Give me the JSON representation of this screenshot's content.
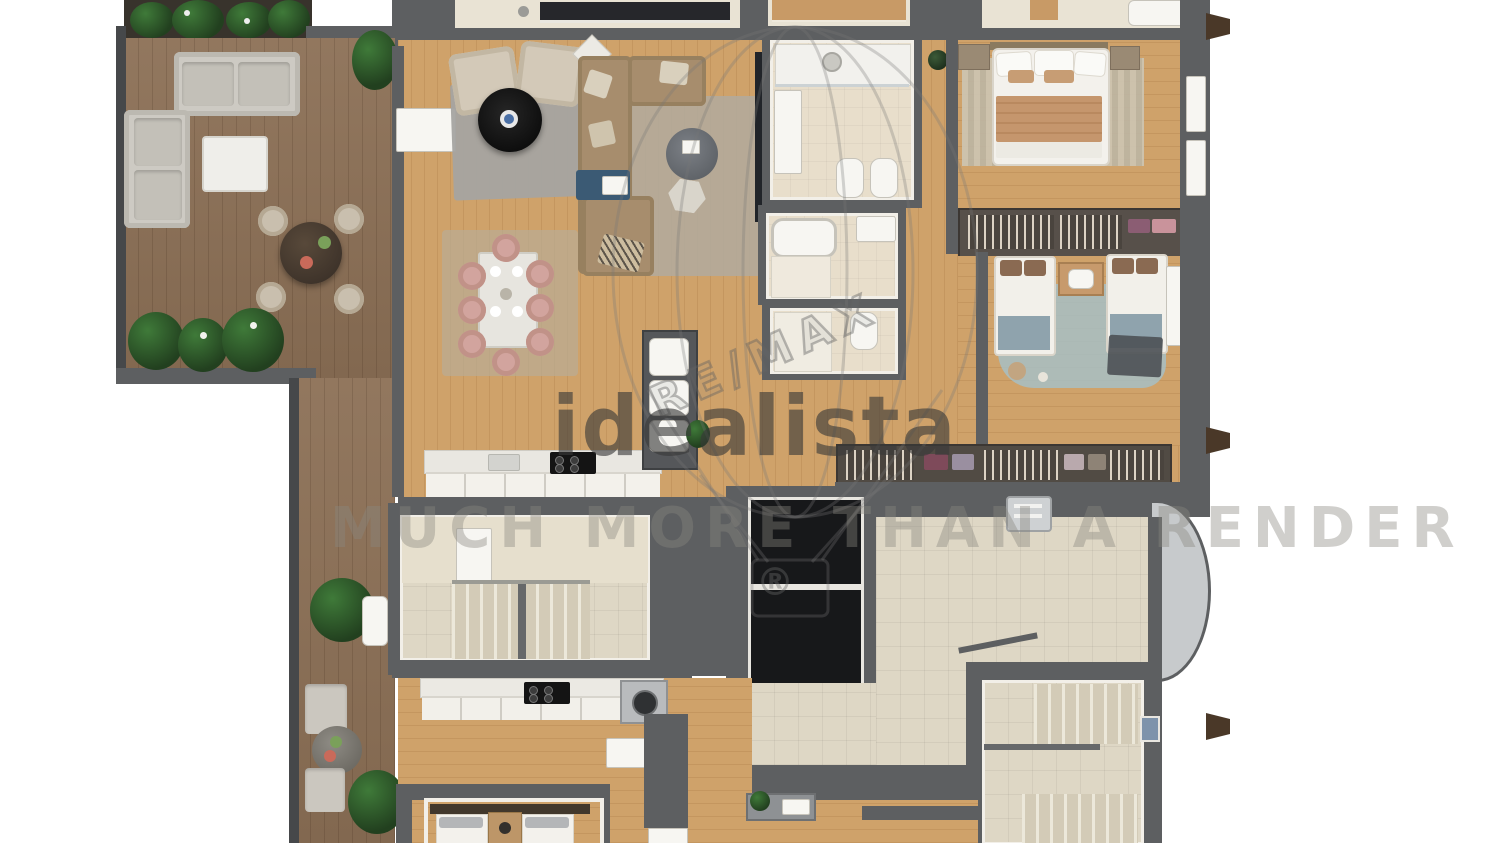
{
  "meta": {
    "type": "3d-floor-plan-render",
    "view": "top-down",
    "description": "Photorealistic top-down 3D floor plan of an apartment level: large wood terrace with outdoor furniture and plants on the left, open living/dining room with kitchen, three bathrooms, master bedroom and twin bedroom with wardrobes on the right, central stairwells, two elevators and landing lobby, and a second partially visible apartment along the bottom edge"
  },
  "watermarks": {
    "brand_center": "idealista",
    "brand_diagonal": "RE/MAX",
    "registered_mark": "®",
    "tagline": "MUCH MORE THAN A RENDER"
  },
  "regions": [
    "terrace",
    "terrace-strip",
    "living-room",
    "dining-area",
    "kitchen",
    "laundry-closet",
    "bathroom-1",
    "bathroom-2",
    "bathroom-3",
    "entry-hallway",
    "master-bedroom",
    "twin-bedroom",
    "wardrobe-row",
    "main-stairwell",
    "elevator-shafts",
    "landing-lobby",
    "secondary-stairwell",
    "lower-apartment-kitchen",
    "lower-apartment-bedroom",
    "lower-apartment-bathroom"
  ],
  "colors": {
    "wall": "#5d5f61",
    "wall-dark": "#46484a",
    "terrace-wood": "#8c7056",
    "interior-wood": "#cfa26a",
    "tile": "#ded7c5",
    "bath-floor": "#e8decb",
    "plant-mid": "#3f7a39",
    "plant-dark": "#22401f",
    "sofa-gray": "#cdcac3",
    "sofa-brown": "#a78d6d",
    "chair-pink": "#d2a49e",
    "rug-teal": "#a7c0c4",
    "elevator-black": "#17181a",
    "accent-blue": "#4a6fa5",
    "watermark-gray": "#6a6a6a"
  }
}
